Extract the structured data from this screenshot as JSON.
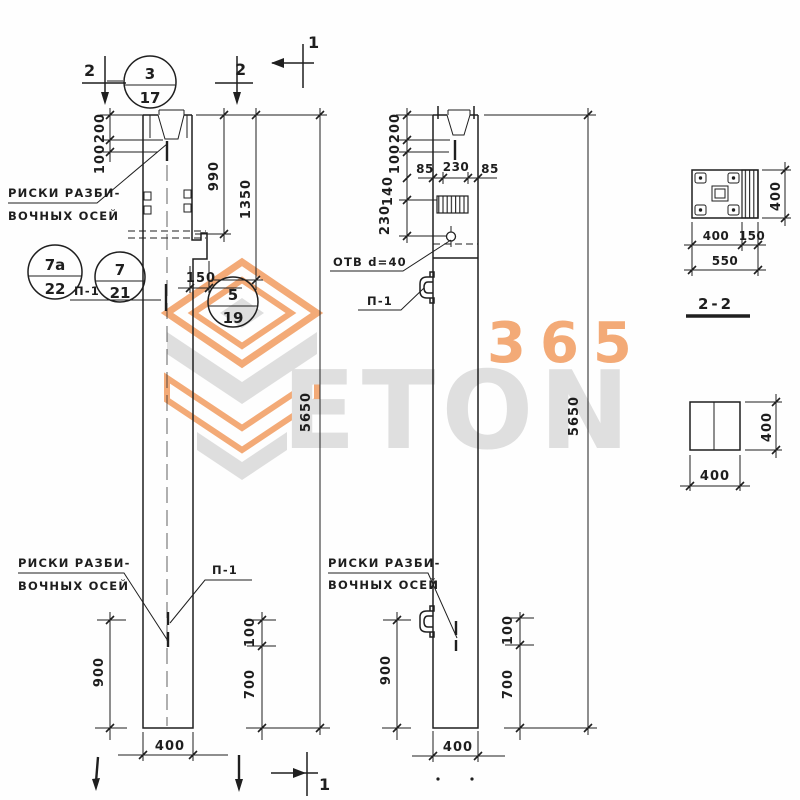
{
  "drawing": {
    "type": "precast concrete column working drawing",
    "views": [
      "column front elevation",
      "column side elevation (1-1)",
      "section 2-2",
      "shaft cross-section"
    ]
  },
  "dims": {
    "d200": "200",
    "d100": "100",
    "d990": "990",
    "d1350": "1350",
    "d5650": "5650",
    "d150": "150",
    "d900": "900",
    "d700": "700",
    "d400": "400",
    "d85": "85",
    "d230": "230",
    "d140": "140",
    "d550": "550"
  },
  "labels": {
    "riski1": "РИСКИ РАЗБИ-",
    "riski2": "ВОЧНЫХ ОСЕЙ",
    "p1": "П-1",
    "otv": "ОТВ d=40",
    "section22": "2-2"
  },
  "marks": {
    "m1": "1",
    "m2": "2"
  },
  "callouts": {
    "c3t": "3",
    "c3b": "17",
    "c7at": "7а",
    "c7ab": "22",
    "c7t": "7",
    "c7b": "21",
    "c5t": "5",
    "c5b": "19"
  },
  "watermark": {
    "brand": "ETON",
    "number": "365",
    "orange": "#f2a269",
    "gray": "#dcdcdc"
  }
}
